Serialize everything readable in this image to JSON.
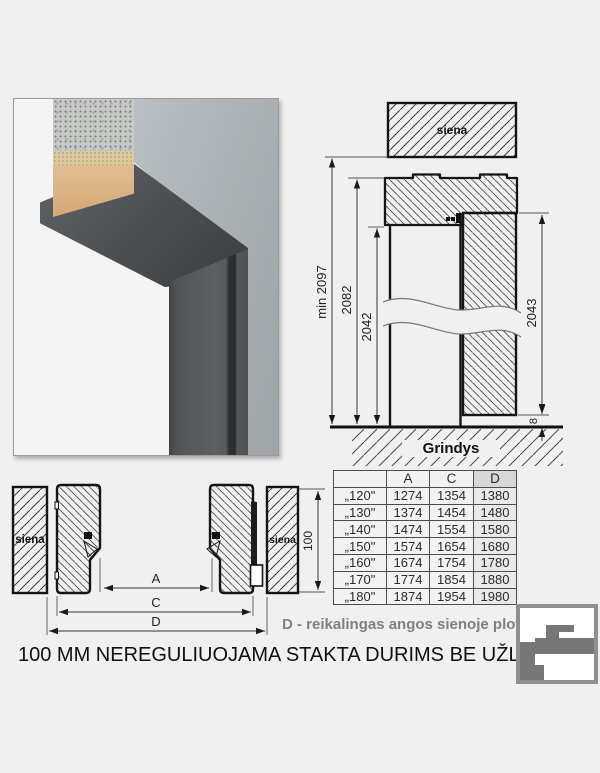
{
  "side_view": {
    "wall_label": "siena",
    "floor_label": "Grindys",
    "dims": {
      "min_total": "min 2097",
      "frame_outer": "2082",
      "frame_opening": "2042",
      "leaf_height": "2043",
      "floor_gap": "8"
    }
  },
  "top_view": {
    "wall_label_left": "siena",
    "wall_label_right": "siena",
    "dims": {
      "a": "A",
      "c": "C",
      "d": "D",
      "frame_depth": "100"
    }
  },
  "size_table": {
    "headers": {
      "size": "",
      "a": "A",
      "c": "C",
      "d": "D"
    },
    "rows": [
      {
        "size": "„120\"",
        "a": "1274",
        "c": "1354",
        "d": "1380"
      },
      {
        "size": "„130\"",
        "a": "1374",
        "c": "1454",
        "d": "1480"
      },
      {
        "size": "„140\"",
        "a": "1474",
        "c": "1554",
        "d": "1580"
      },
      {
        "size": "„150\"",
        "a": "1574",
        "c": "1654",
        "d": "1680"
      },
      {
        "size": "„160\"",
        "a": "1674",
        "c": "1754",
        "d": "1780"
      },
      {
        "size": "„170\"",
        "a": "1774",
        "c": "1854",
        "d": "1880"
      },
      {
        "size": "„180\"",
        "a": "1874",
        "c": "1954",
        "d": "1980"
      }
    ]
  },
  "notes": {
    "d_note": "D - reikalingas angos sienoje plotis"
  },
  "title": "100 MM NEREGULIUOJAMA STAKTA DURIMS BE UŽLAIDOS",
  "colors": {
    "frame_dark": "#54585a",
    "wall_gray": "#b2b8bb",
    "note_gray": "#808080",
    "hatch": "#444444",
    "page_bg": "#f0f0f1"
  }
}
